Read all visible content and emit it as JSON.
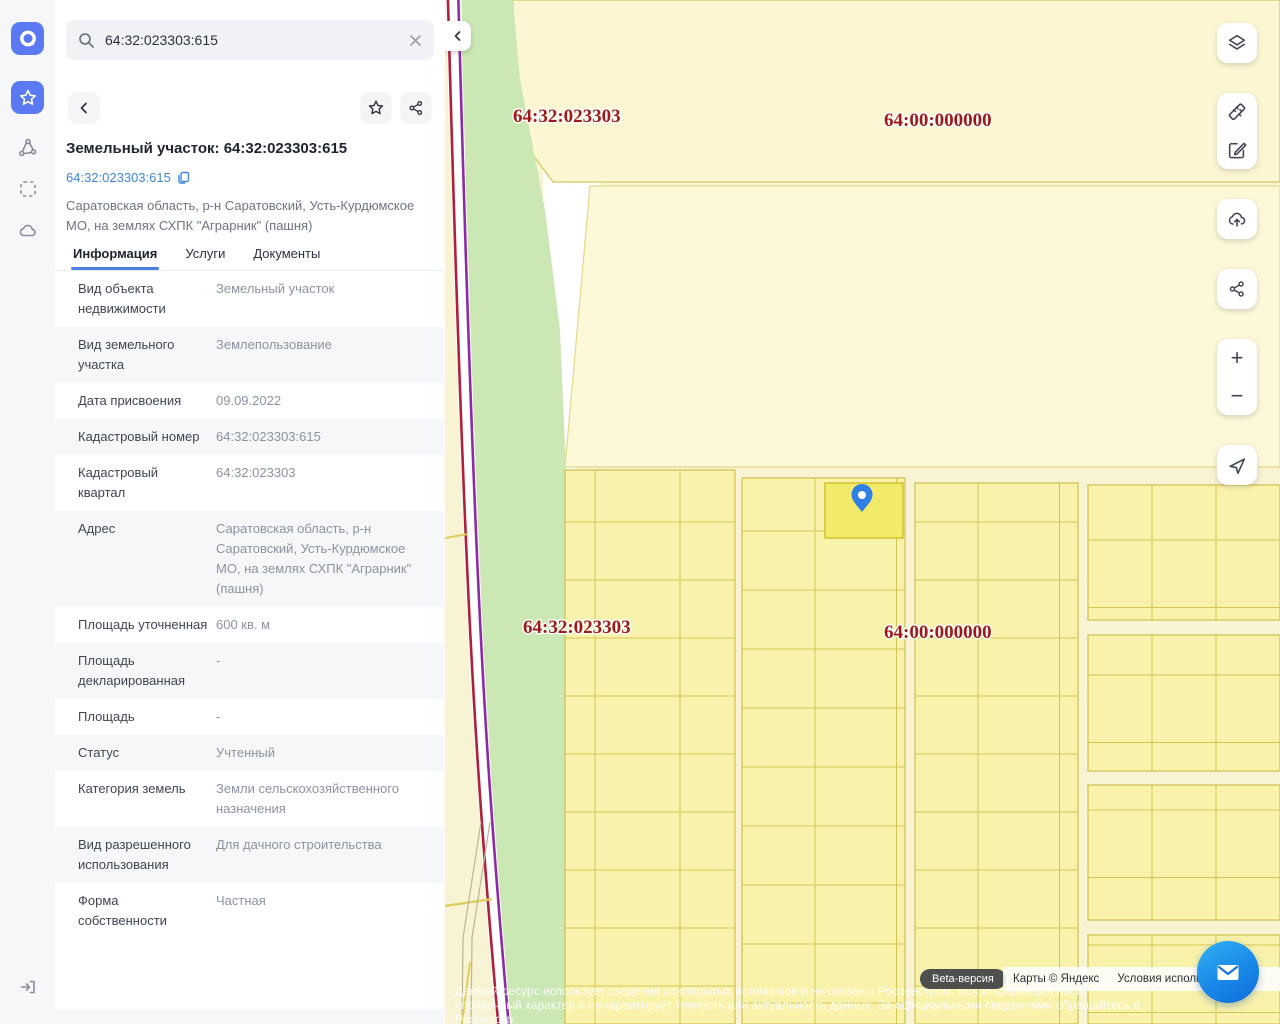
{
  "app": {
    "logo_glyph": "a"
  },
  "sidebar": {
    "items": [
      {
        "icon": "star-icon",
        "active": true
      },
      {
        "icon": "polygon-nodes-icon",
        "active": false
      },
      {
        "icon": "area-select-icon",
        "active": false
      },
      {
        "icon": "cloud-icon",
        "active": false
      }
    ],
    "logout_icon": "logout-icon"
  },
  "search": {
    "value": "64:32:023303:615"
  },
  "detail": {
    "title": "Земельный участок: 64:32:023303:615",
    "cadastral_link": "64:32:023303:615",
    "address_summary": "Саратовская область, р-н Саратовский, Усть-Курдюмское МО, на землях СХПК \"Аграрник\" (пашня)",
    "tabs": [
      {
        "label": "Информация",
        "active": true
      },
      {
        "label": "Услуги",
        "active": false
      },
      {
        "label": "Документы",
        "active": false
      }
    ],
    "rows": [
      {
        "label": "Вид объекта недвижимости",
        "value": "Земельный участок"
      },
      {
        "label": "Вид земельного участка",
        "value": "Землепользование"
      },
      {
        "label": "Дата присвоения",
        "value": "09.09.2022"
      },
      {
        "label": "Кадастровый номер",
        "value": "64:32:023303:615"
      },
      {
        "label": "Кадастровый квартал",
        "value": "64:32:023303"
      },
      {
        "label": "Адрес",
        "value": "Саратовская область, р-н Саратовский, Усть-Курдюмское МО, на землях СХПК \"Аграрник\" (пашня)"
      },
      {
        "label": "Площадь уточненная",
        "value": "600 кв. м"
      },
      {
        "label": "Площадь декларированная",
        "value": "-"
      },
      {
        "label": "Площадь",
        "value": "-"
      },
      {
        "label": "Статус",
        "value": "Учтенный"
      },
      {
        "label": "Категория земель",
        "value": "Земли сельскохозяйственного назначения"
      },
      {
        "label": "Вид разрешенного использования",
        "value": "Для дачного строительства"
      },
      {
        "label": "Форма собственности",
        "value": "Частная"
      }
    ]
  },
  "map": {
    "labels": [
      {
        "text": "64:32:023303"
      },
      {
        "text": "64:00:000000"
      },
      {
        "text": "64:32:023303"
      },
      {
        "text": "64:00:000000"
      }
    ],
    "controls": [
      "layers-icon",
      "ruler-icon",
      "edit-icon",
      "cloud-upload-icon",
      "share-icon",
      "zoom-in",
      "zoom-out",
      "locate-icon"
    ],
    "zoom_in_label": "+",
    "zoom_out_label": "−",
    "beta_badge": "Beta-версия",
    "attribution": {
      "maps_copyright": "Карты © Яндекс",
      "terms": "Условия использования"
    },
    "disclaimer": "Данный ресурс использует сведения из открытых источников и не связан с Росреестром. Вся информация носит справочный характер и не гарантирует точность или актуальность данных. За официальными сведениями обращайтесь в Росреестр."
  },
  "colors": {
    "accent_blue": "#5b79f2",
    "link_blue": "#3e87e0",
    "tab_underline": "#4b7fe4",
    "map_label_red": "#9e1a1a",
    "parcel_fill": "#f8f2ab",
    "selected_parcel_fill": "#f1ea6b",
    "forest_green": "#cbe7b3",
    "road_red": "#b0203c",
    "road_purple": "#8d2ba6",
    "pin_blue": "#2f7fe5"
  }
}
